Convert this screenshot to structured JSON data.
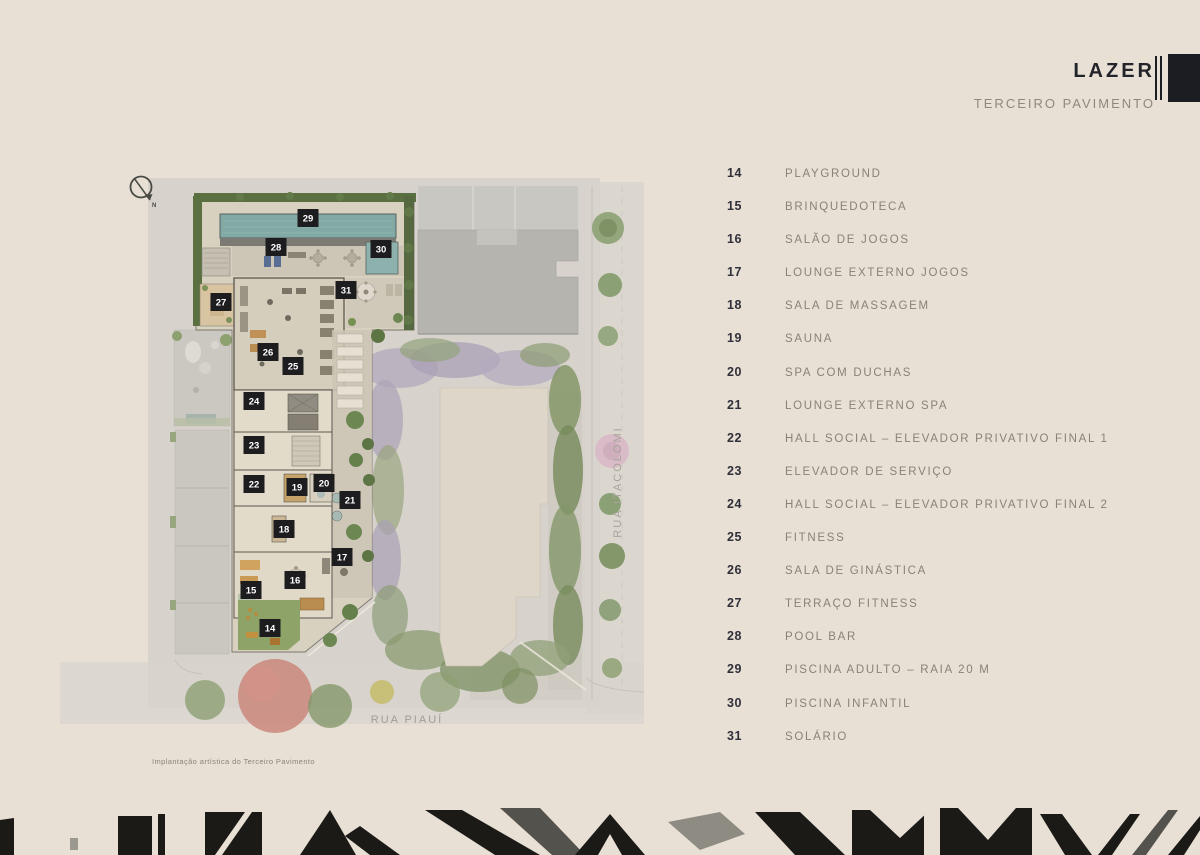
{
  "header": {
    "title": "LAZER",
    "subtitle": "TERCEIRO PAVIMENTO"
  },
  "legend": [
    {
      "num": "14",
      "label": "PLAYGROUND"
    },
    {
      "num": "15",
      "label": "BRINQUEDOTECA"
    },
    {
      "num": "16",
      "label": "SALÃO DE JOGOS"
    },
    {
      "num": "17",
      "label": "LOUNGE EXTERNO JOGOS"
    },
    {
      "num": "18",
      "label": "SALA DE MASSAGEM"
    },
    {
      "num": "19",
      "label": "SAUNA"
    },
    {
      "num": "20",
      "label": "SPA COM DUCHAS"
    },
    {
      "num": "21",
      "label": "LOUNGE EXTERNO SPA"
    },
    {
      "num": "22",
      "label": "HALL SOCIAL – ELEVADOR PRIVATIVO FINAL 1"
    },
    {
      "num": "23",
      "label": "ELEVADOR DE SERVIÇO"
    },
    {
      "num": "24",
      "label": "HALL SOCIAL – ELEVADOR PRIVATIVO FINAL 2"
    },
    {
      "num": "25",
      "label": "FITNESS"
    },
    {
      "num": "26",
      "label": "SALA DE GINÁSTICA"
    },
    {
      "num": "27",
      "label": "TERRAÇO FITNESS"
    },
    {
      "num": "28",
      "label": "POOL BAR"
    },
    {
      "num": "29",
      "label": "PISCINA ADULTO – RAIA 20 M"
    },
    {
      "num": "30",
      "label": "PISCINA INFANTIL"
    },
    {
      "num": "31",
      "label": "SOLÁRIO"
    }
  ],
  "plan": {
    "caption": "Implantação artística do Terceiro Pavimento",
    "streets": {
      "bottom": "RUA PIAUÍ",
      "right": "RUA ITACOLOMI"
    },
    "north_label": "N",
    "markers": [
      {
        "num": "29",
        "x": 308,
        "y": 218
      },
      {
        "num": "28",
        "x": 276,
        "y": 247
      },
      {
        "num": "30",
        "x": 381,
        "y": 249
      },
      {
        "num": "31",
        "x": 346,
        "y": 290
      },
      {
        "num": "27",
        "x": 221,
        "y": 302
      },
      {
        "num": "26",
        "x": 268,
        "y": 352
      },
      {
        "num": "25",
        "x": 293,
        "y": 366
      },
      {
        "num": "24",
        "x": 254,
        "y": 401
      },
      {
        "num": "23",
        "x": 254,
        "y": 445
      },
      {
        "num": "22",
        "x": 254,
        "y": 484
      },
      {
        "num": "19",
        "x": 297,
        "y": 487
      },
      {
        "num": "20",
        "x": 324,
        "y": 483
      },
      {
        "num": "21",
        "x": 350,
        "y": 500
      },
      {
        "num": "18",
        "x": 284,
        "y": 529
      },
      {
        "num": "17",
        "x": 342,
        "y": 557
      },
      {
        "num": "16",
        "x": 295,
        "y": 580
      },
      {
        "num": "15",
        "x": 251,
        "y": 590
      },
      {
        "num": "14",
        "x": 270,
        "y": 628
      }
    ]
  },
  "colors": {
    "page_bg": "#e8e0d5",
    "marker_bg": "#1d1d20",
    "marker_text": "#ffffff",
    "pool": "#82a9a4",
    "hedge_green": "#5a7041",
    "title": "#23242a",
    "muted_text": "#8d8880"
  }
}
